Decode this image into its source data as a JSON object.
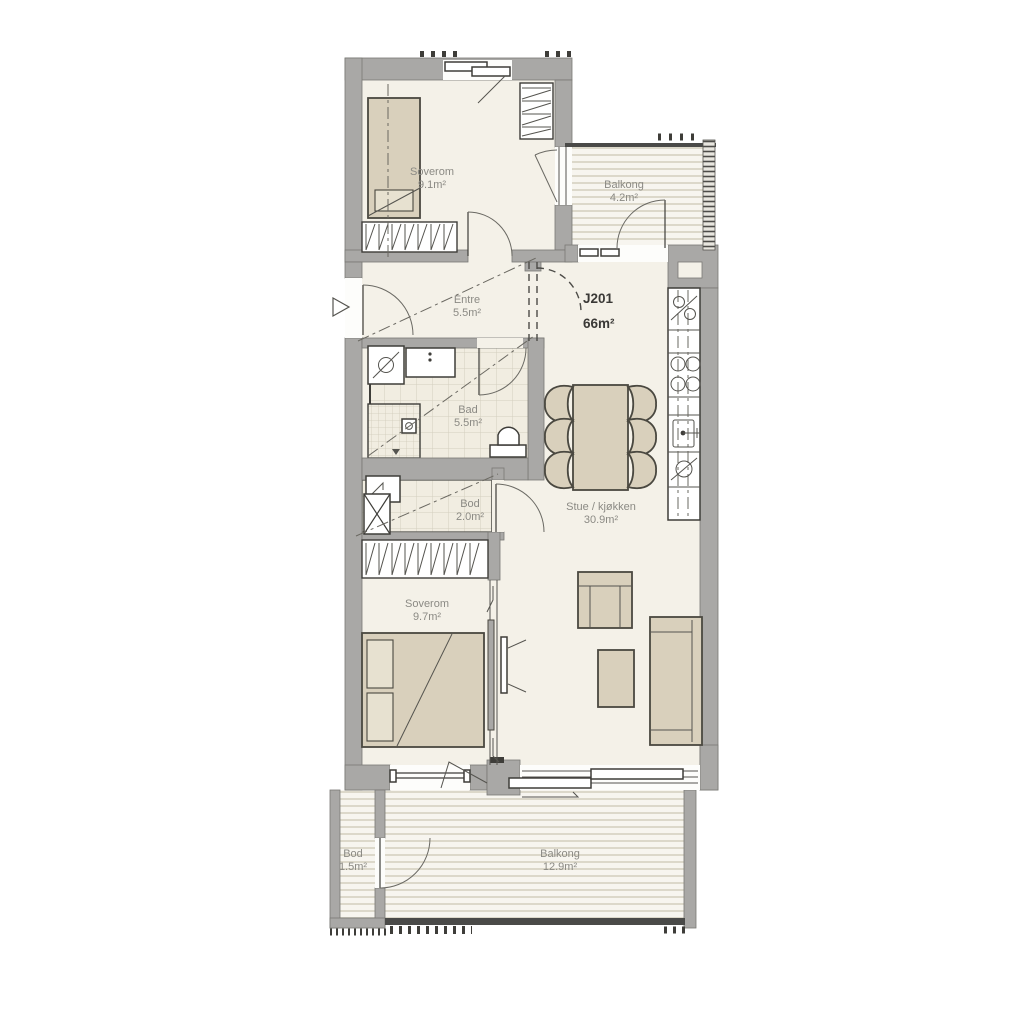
{
  "unit": {
    "id": "J201",
    "area": "66m²"
  },
  "rooms": [
    {
      "key": "soverom-1",
      "name": "Soverom",
      "area": "9.1m²"
    },
    {
      "key": "balkong-1",
      "name": "Balkong",
      "area": "4.2m²"
    },
    {
      "key": "entre",
      "name": "Entre",
      "area": "5.5m²"
    },
    {
      "key": "bad",
      "name": "Bad",
      "area": "5.5m²"
    },
    {
      "key": "bod-interior",
      "name": "Bod",
      "area": "2.0m²"
    },
    {
      "key": "stue-kjokken",
      "name": "Stue / kjøkken",
      "area": "30.9m²"
    },
    {
      "key": "soverom-2",
      "name": "Soverom",
      "area": "9.7m²"
    },
    {
      "key": "bod-balkong",
      "name": "Bod",
      "area": "1.5m²"
    },
    {
      "key": "balkong-2",
      "name": "Balkong",
      "area": "12.9m²"
    }
  ],
  "symbols": [
    "fridge-freezer-icon",
    "stove-icon",
    "kitchen-sink-icon",
    "dishwasher-icon",
    "washing-machine-icon",
    "shower-icon",
    "toilet-icon",
    "water-heater-icon",
    "wardrobe-hatch",
    "entrance-arrow-icon",
    "tv-icon"
  ],
  "colors": {
    "wall": "#a9a8a6",
    "floor": "#f4f1e8",
    "furniture": "#d9d0bc",
    "label": "#8b8a84",
    "outline": "#3e3d39",
    "deck": "#f6f4ed"
  }
}
